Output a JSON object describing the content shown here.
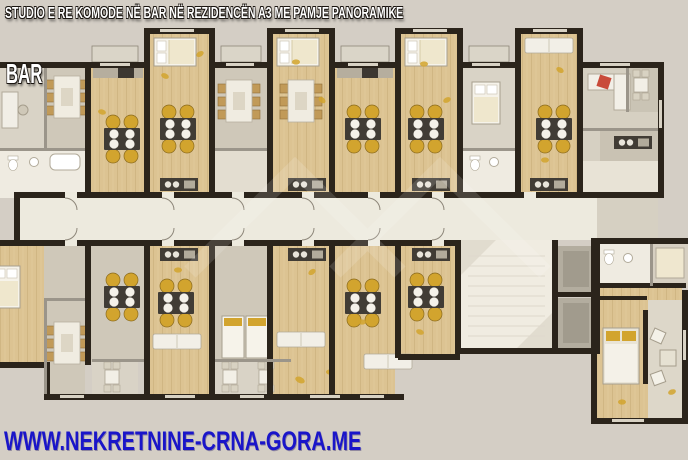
{
  "header": {
    "title": "STUDIO E RE KOMODE NË BAR NË REZIDENCËN A3 ME PAMJE PANORAMIKE",
    "location_label": "BAR"
  },
  "footer": {
    "website": "WWW.NEKRETNINE-CRNA-GORA.ME"
  },
  "floor_plan": {
    "kind": "residential-building-floor-plan",
    "features": "apartments with dining tables, beds, kitchens and bathrooms along a central corridor with stairwell and elevators"
  },
  "colors": {
    "background": "#d4cec5",
    "wall": "#2b241b",
    "wood_floor": "#dcc392",
    "room_beige": "#cfc8b9",
    "room_light": "#d9d3c6",
    "bathroom": "#efebe1",
    "corridor": "#edeade",
    "counter_dark": "#413c35",
    "chair_yellow": "#d2a42e",
    "accent_red": "#c94b3a",
    "title_color": "#ffffff",
    "website_color": "#1a15c9"
  }
}
